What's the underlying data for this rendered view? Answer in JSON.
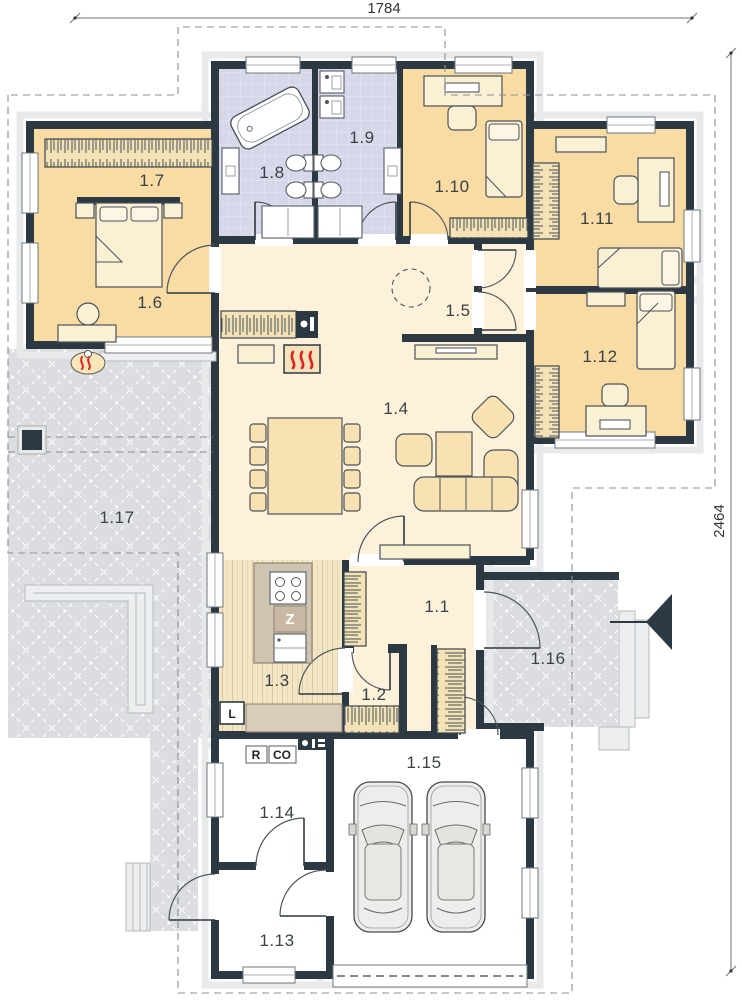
{
  "plan": {
    "title_dimensions": {
      "width": "1784",
      "height": "2464"
    },
    "rooms": [
      {
        "label": "1.1"
      },
      {
        "label": "1.2"
      },
      {
        "label": "1.3"
      },
      {
        "label": "1.4"
      },
      {
        "label": "1.5"
      },
      {
        "label": "1.6"
      },
      {
        "label": "1.7"
      },
      {
        "label": "1.8"
      },
      {
        "label": "1.9"
      },
      {
        "label": "1.10"
      },
      {
        "label": "1.11"
      },
      {
        "label": "1.12"
      },
      {
        "label": "1.13"
      },
      {
        "label": "1.14"
      },
      {
        "label": "1.15"
      },
      {
        "label": "1.16"
      },
      {
        "label": "1.17"
      }
    ],
    "markers": {
      "fridge": "L",
      "sink": "Z",
      "boiler": "R",
      "heating": "CO"
    },
    "colors": {
      "wall": "#2d3942",
      "bedroom_floor": "#f8dca4",
      "living_floor": "#fdf2d9",
      "bath_floor": "#d6d7e9",
      "terrace": "#dbdde0",
      "kitchen_floor": "#f2e6c5",
      "flame_red": "#e02020"
    }
  }
}
